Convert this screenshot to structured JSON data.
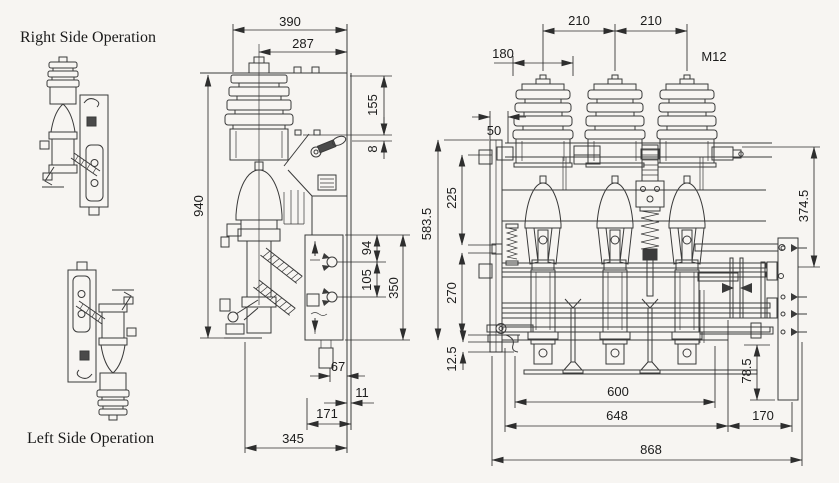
{
  "page": {
    "paper": "#f7f5f2",
    "ink": "#3a3a3a"
  },
  "titles": {
    "right_side": "Right Side Operation",
    "left_side": "Left Side Operation"
  },
  "side_view": {
    "width": "390",
    "width_upper": "287",
    "bushing_height": "155",
    "gap": "8",
    "height": "940",
    "hole_top": "94",
    "hole_pitch": "105",
    "plate_height": "350",
    "foot": "67",
    "panel": "11",
    "base_width": "171",
    "depth": "345"
  },
  "front_view": {
    "pitch_left": "210",
    "pitch_right": "210",
    "bushing_width": "180",
    "frame_width": "50",
    "thread": "M12",
    "upper_height": "225",
    "total_height": "583.5",
    "lower_height": "270",
    "foot_gap": "12.5",
    "right_height": "374.5",
    "bracket_height": "78.5",
    "mount_width": "600",
    "frame_span": "648",
    "extension": "170",
    "total_width": "868"
  }
}
